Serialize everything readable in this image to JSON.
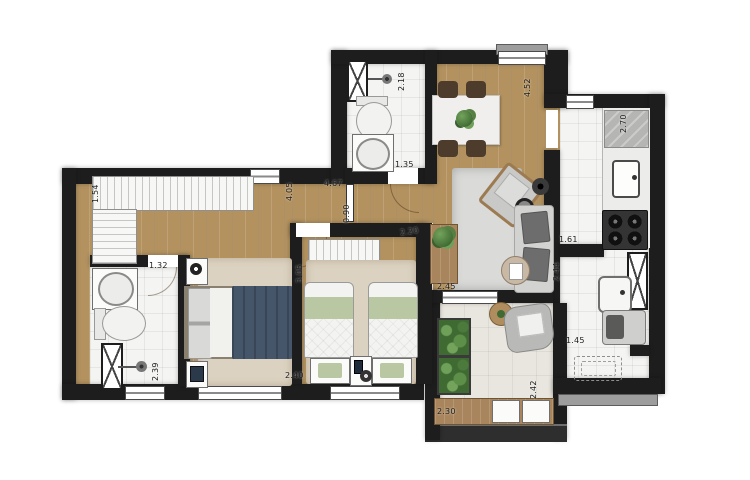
{
  "title": "2-bedroom apartment floor plan (top view)",
  "colors": {
    "wall": "#1d1d1d",
    "wood_floor": "#b3925f",
    "tile_floor": "#f4f4f2",
    "balcony_floor": "#e9e6df",
    "double_bed_duvet": "#46566a",
    "single_bed_blanket": "#b9c7a3",
    "plant": "#4c7a3c",
    "dimension_text": "#202020"
  },
  "dimensions": {
    "closet": "1.54",
    "hall_a": "4.05",
    "hall_b": "4.67",
    "door": "0.90",
    "bath2_len": "2.18",
    "bath2_wid": "1.35",
    "living_len": "4.52",
    "kitchen_len": "2.70",
    "kitchen_wid": "1.61",
    "laundry_len": "2.44",
    "laundry_wid": "1.45",
    "console": "2.45",
    "bed2_wid": "2.20",
    "bed2_len": "3.05",
    "bath1_wid": "1.32",
    "bath1_len": "2.39",
    "bed1_wid": "2.40",
    "balcony_len": "2.42",
    "balcony_wid": "2.30"
  }
}
